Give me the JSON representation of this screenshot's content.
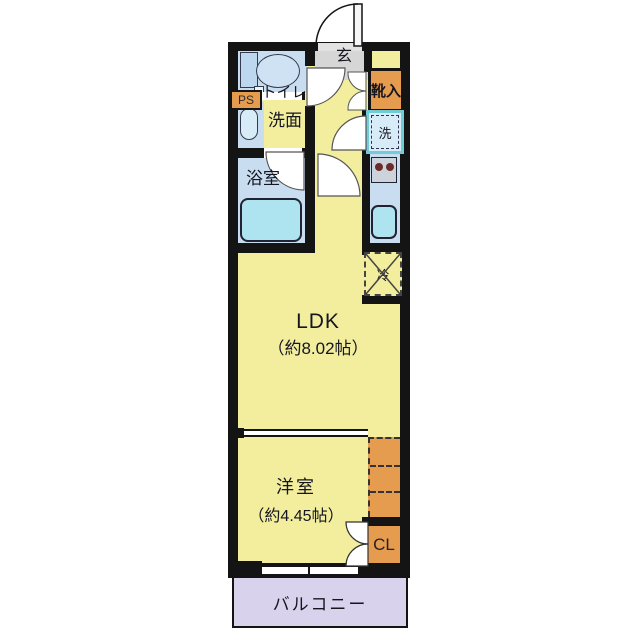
{
  "floorplan": {
    "rooms": {
      "genkan": {
        "label": "玄"
      },
      "toilet": {
        "label": "トイレ"
      },
      "washroom": {
        "label": "洗面"
      },
      "bathroom": {
        "label": "浴室"
      },
      "ldk": {
        "name": "LDK",
        "size": "（約8.02帖）"
      },
      "bedroom": {
        "name": "洋室",
        "size": "（約4.45帖）"
      },
      "balcony": {
        "label": "バルコニー"
      }
    },
    "fixtures": {
      "pipe_shaft": {
        "label": "PS"
      },
      "shoe_cabinet": {
        "label": "靴入"
      },
      "washer": {
        "label": "洗"
      },
      "fridge": {
        "label": "冷"
      },
      "closet": {
        "label": "CL"
      }
    },
    "colors": {
      "wall": "#141414",
      "yellow": "#f2ee9e",
      "blue": "#c9ddf0",
      "cyan": "#aee4f0",
      "orange": "#e69c4e",
      "gray": "#d6d6d6",
      "purple": "#d8d2ec",
      "ink": "#15151f",
      "washerframe": "#72ccd8"
    }
  }
}
